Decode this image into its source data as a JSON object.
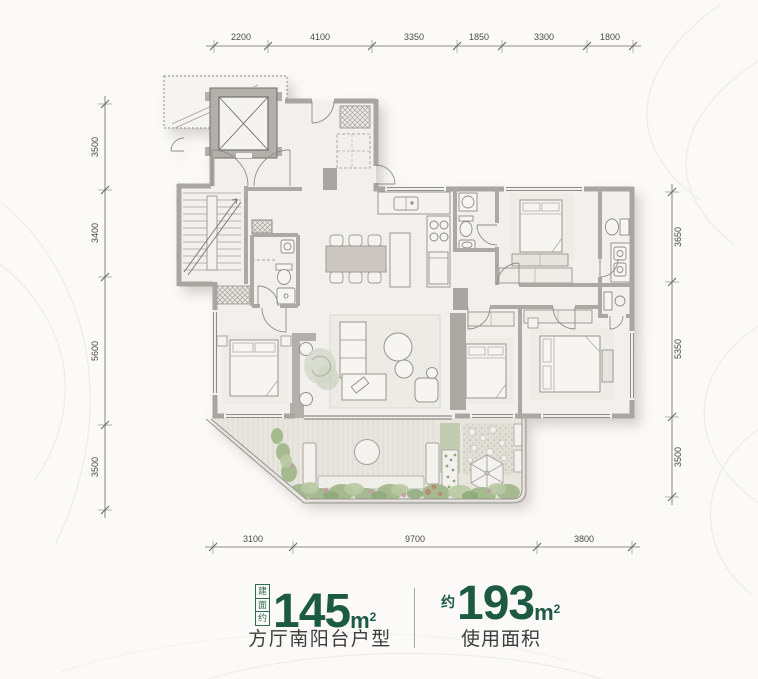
{
  "dimensions": {
    "top": [
      "2200",
      "4100",
      "3350",
      "1850",
      "3300",
      "1800"
    ],
    "left": [
      "3500",
      "3400",
      "5600",
      "3500"
    ],
    "right": [
      "3650",
      "5350",
      "3500"
    ],
    "bottom": [
      "3100",
      "9700",
      "3800"
    ]
  },
  "caption": {
    "build_area_tag": "建面约",
    "build_area_value": "145",
    "unit_base": "m",
    "unit_sup": "2",
    "build_area_label": "方厅南阳台户型",
    "use_area_prefix": "约",
    "use_area_value": "193",
    "use_area_label": "使用面积"
  },
  "colors": {
    "accent_green": "#1c5a41",
    "tag_green": "#2d6b4e",
    "caption_text": "#3d3d3d",
    "wall_gray": "#a9a6a1",
    "floor_fill": "#f2f0ec",
    "deck_fill": "#e9e6e0",
    "plant_green": "#a3b88c",
    "dim_text": "#4c4a47",
    "background": "#fbfaf8"
  }
}
